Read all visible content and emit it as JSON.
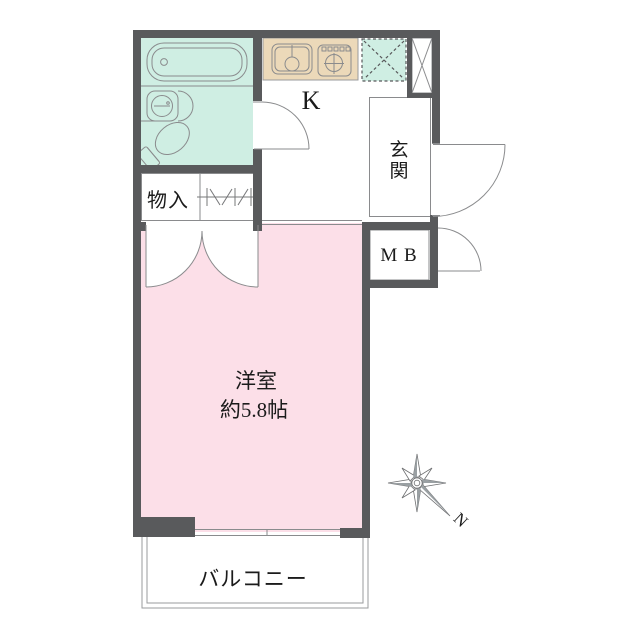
{
  "plan_title": "apartment-floor-plan",
  "colors": {
    "wall": "#595a5c",
    "bathroom_fill": "#cfeee3",
    "washing_area_fill": "#cfeee3",
    "counter_fill": "#ecd9b9",
    "room_fill": "#fcdfe8",
    "line": "#8a8b8d",
    "balcony_line": "#9a9b9d",
    "text": "#1b1b1b"
  },
  "rooms": {
    "kitchen": {
      "label": "K"
    },
    "entrance": {
      "label": "玄関",
      "char1": "玄",
      "char2": "関"
    },
    "meter_box": {
      "label": "M B"
    },
    "storage": {
      "label": "物入"
    },
    "western_room": {
      "label": "洋室",
      "area": "約5.8帖"
    },
    "balcony": {
      "label": "バルコニー"
    }
  },
  "compass": {
    "north_label": "N"
  }
}
